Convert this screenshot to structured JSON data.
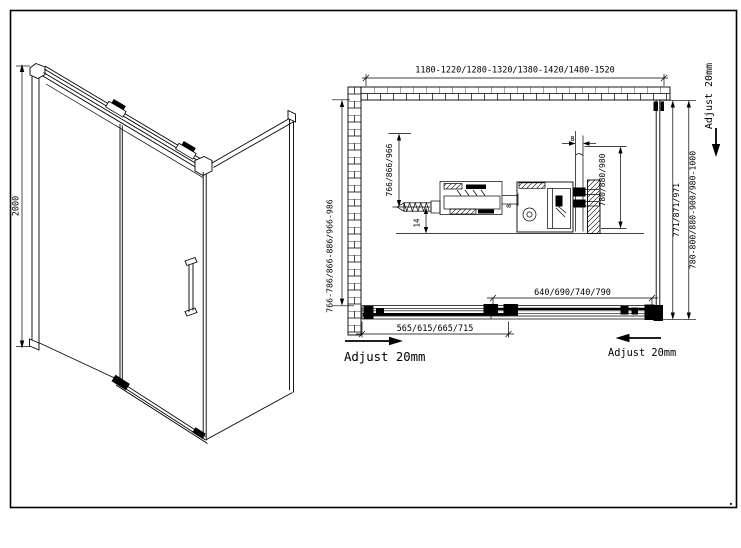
{
  "page": {
    "background": "#ffffff",
    "line_color": "#000000",
    "description": "Shower enclosure technical drawing: 3D view and plan view with dimensions"
  },
  "view3d": {
    "height_label": "2000"
  },
  "plan": {
    "width_label": "1180-1220/1280-1320/1380-1420/1480-1520",
    "left_depth_label": "766-786/866-886/966-986",
    "right_depth_inner_label": "771/871/971",
    "right_depth_outer_label": "780-800/880-900/980-1000",
    "fixed_panel_label": "565/615/665/715",
    "sliding_door_label": "640/690/740/790",
    "adjust_bottom_left": "Adjust 20mm",
    "adjust_bottom_right": "Adjust 20mm",
    "adjust_top_right": "Adjust 20mm"
  },
  "detail": {
    "arm_height_label": "766/866/966",
    "bar_height_label": "780/880/980",
    "glass_thickness_top_label": "8",
    "glass_thickness_arm_label": "8",
    "floor_offset_label": "14"
  }
}
